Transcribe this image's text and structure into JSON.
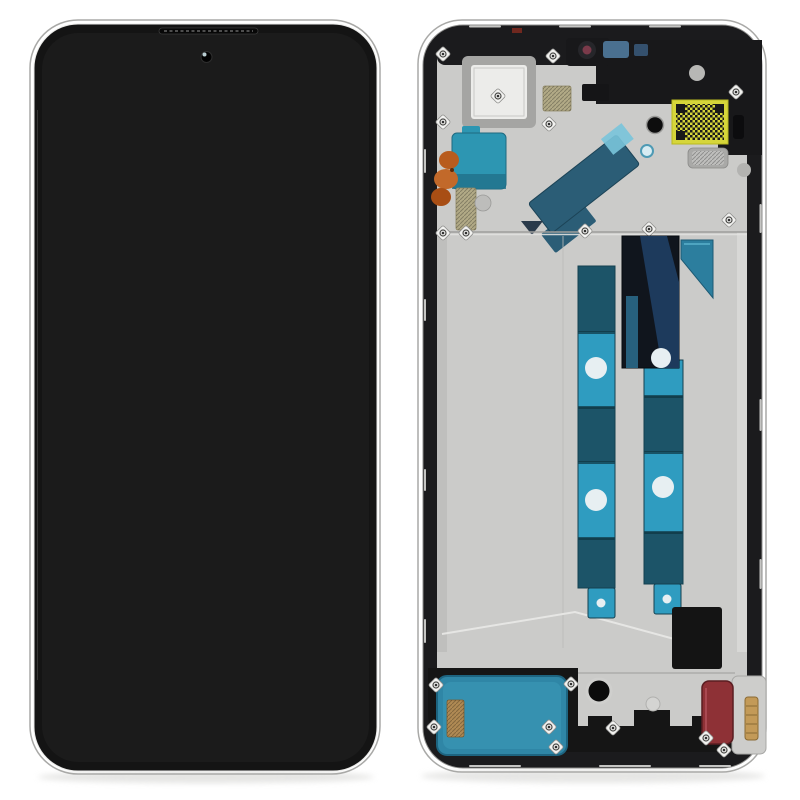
{
  "scene": {
    "description": "Product photo: smartphone LCD screen and digitizer assembly with middle frame, shown from the front (assembled black display) and from the back (frame with flex cables, graphite strips and adhesive pads) on a white background."
  },
  "front_view": {
    "title": "Front view - assembled black LCD display",
    "parts": [
      {
        "id": "display-glass",
        "label": "black display glass",
        "color_ref": "screen-black"
      },
      {
        "id": "front-camera",
        "label": "punch-hole selfie camera",
        "color_ref": "black-part"
      },
      {
        "id": "earpiece-slit",
        "label": "earpiece speaker slit",
        "color_ref": "black-part"
      }
    ]
  },
  "back_view": {
    "title": "Back view - display middle frame with flex cables and adhesive strips",
    "parts": [
      {
        "id": "middle-frame",
        "label": "black middle frame with silver back plate",
        "color_ref": "frame-black"
      },
      {
        "id": "camera-cutout",
        "label": "square rear camera cutout",
        "color_ref": "cutout-inner"
      },
      {
        "id": "front-camera-lens",
        "label": "front camera lens seen from behind",
        "color_ref": "lens-ring"
      },
      {
        "id": "qr-sticker",
        "label": "yellow QR code sticker",
        "color_ref": "qr-yellow"
      },
      {
        "id": "teal-adhesive-top",
        "label": "teal adhesive pad (top left)",
        "color_ref": "teal-patch"
      },
      {
        "id": "orange-flex",
        "label": "orange flex cable on left edge",
        "color_ref": "orange-flex"
      },
      {
        "id": "diagonal-flex",
        "label": "diagonal dark-teal flex cable",
        "color_ref": "teal-flex"
      },
      {
        "id": "graphite-strip-left",
        "label": "left vertical graphite/adhesive strip",
        "color_ref": "teal-light"
      },
      {
        "id": "graphite-strip-right",
        "label": "right vertical graphite/adhesive strip",
        "color_ref": "teal-light"
      },
      {
        "id": "navy-film",
        "label": "dark navy film over right strip",
        "color_ref": "navy-patch"
      },
      {
        "id": "speaker-adhesive-bottom",
        "label": "teal loudspeaker adhesive (bottom left)",
        "color_ref": "teal-bottom"
      },
      {
        "id": "microphone-hole",
        "label": "black round microphone hole",
        "color_ref": "black-part"
      },
      {
        "id": "charging-flex",
        "label": "dark red charging-port flex",
        "color_ref": "red-component"
      },
      {
        "id": "gold-connector",
        "label": "gold board-to-board connector",
        "color_ref": "tan-connector"
      },
      {
        "id": "screw-holes",
        "label": "silver screw holes",
        "count": 19,
        "color_ref": "screw-white"
      }
    ]
  },
  "colors": {
    "background": "#ffffff",
    "screen-black": "#141414",
    "screen-inner": "#1b1b1b",
    "body-outline": "#a9a9a7",
    "frame-black": "#1b1b1d",
    "frame-glint": "#d8d8d6",
    "plate-silver": "#cbcbc9",
    "plate-rail-dark": "#bfbfbd",
    "plate-rail-light": "#d8d8d6",
    "deck-dark": "#18181a",
    "cutout-border": "#a5a5a3",
    "cutout-inner": "#ececea",
    "teal-patch": "#2d96b2",
    "teal-dark": "#1c5468",
    "teal-light": "#2f9cc0",
    "teal-flex": "#2b5d76",
    "teal-flex-tip": "#79c4da",
    "teal-angle": "#2c7e9e",
    "teal-bottom": "#2f86a6",
    "teal-bottom-inner": "#3c9ab8",
    "navy-patch": "#10151d",
    "navy-band": "#1d3a5c",
    "qr-yellow": "#d6d63a",
    "orange-flex": "#b85c1e",
    "orange-flex-light": "#c2692a",
    "orange-flex-dark": "#a84e14",
    "tan-pad": "#b2aa86",
    "tan-connector": "#c39a58",
    "red-component": "#8e3136",
    "hole-white": "#e7eff2",
    "screw-white": "#f2f2f0",
    "black-part": "#141414",
    "lens-ring": "#7a3a4a",
    "blue-chip": "#4a7090",
    "shadow": "#d9d9d7",
    "crease": "#e9e9e7",
    "seam": "#bcbcba"
  }
}
